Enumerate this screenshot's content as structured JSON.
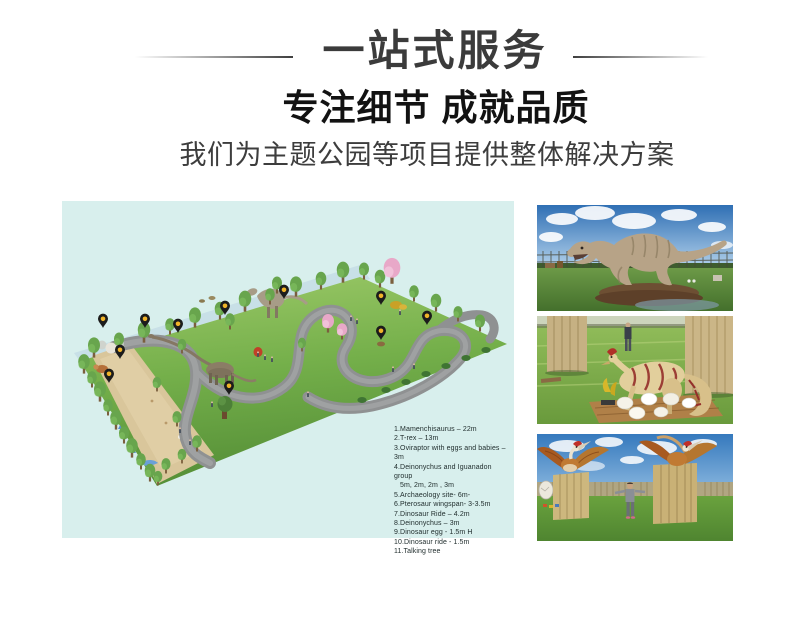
{
  "header": {
    "banner_title": "一站式服务",
    "headline": "专注细节 成就品质",
    "subtitle": "我们为主题公园等项目提供整体解决方案"
  },
  "park_map": {
    "background_color": "#d8efed",
    "pin_color": "#1c1c1c",
    "pin_dot_color": "#f0b429",
    "legend_items": [
      "1.Mamenchisaurus – 22m",
      "2.T-rex – 13m",
      "3.Oviraptor with eggs and babies – 3m",
      "4.Deinonychus and Iguanadon group",
      "5m, 2m, 2m , 3m",
      "5.Archaeology site- 6m-",
      "6.Pterosaur  wingspan- 3-3.5m",
      "7.Dinosaur Ride – 4.2m",
      "8.Deinonychus – 3m",
      "9.Dinosaur egg - 1.5m H",
      "10.Dinosaur ride -  1.5m",
      "11.Talking tree"
    ]
  },
  "photos": [
    {
      "name": "t-rex-exhibit-photo"
    },
    {
      "name": "oviraptor-with-eggs-photo"
    },
    {
      "name": "pterosaur-exhibit-photo"
    }
  ]
}
